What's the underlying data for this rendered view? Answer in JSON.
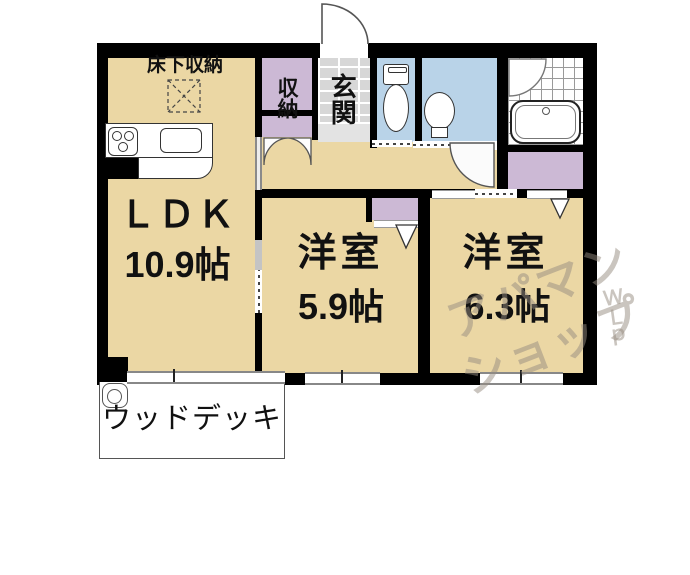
{
  "floorplan": {
    "ldk": {
      "label": "ＬＤＫ",
      "area": "10.9帖"
    },
    "floor_storage": {
      "label": "床下収納"
    },
    "hall_closet": {
      "label": "収納"
    },
    "entrance": {
      "label": "玄関"
    },
    "bedroom1": {
      "label": "洋室",
      "area": "5.9帖"
    },
    "bedroom2": {
      "label": "洋室",
      "area": "6.3帖"
    },
    "wood_deck": {
      "label": "ウッドデッキ"
    }
  },
  "watermark": {
    "line1": "アパマン",
    "line2": "ショップ",
    "side": "ＷＬｐ"
  },
  "colors": {
    "floor": "#ebd7a4",
    "closet": "#ccb9d5",
    "wetroom": "#b9d3e8",
    "tile": "#d7d7d7",
    "tile_step": "#e3e3e3",
    "wall": "#000000",
    "deck_border": "#555555",
    "watermark": "rgba(150,140,128,0.5)"
  }
}
